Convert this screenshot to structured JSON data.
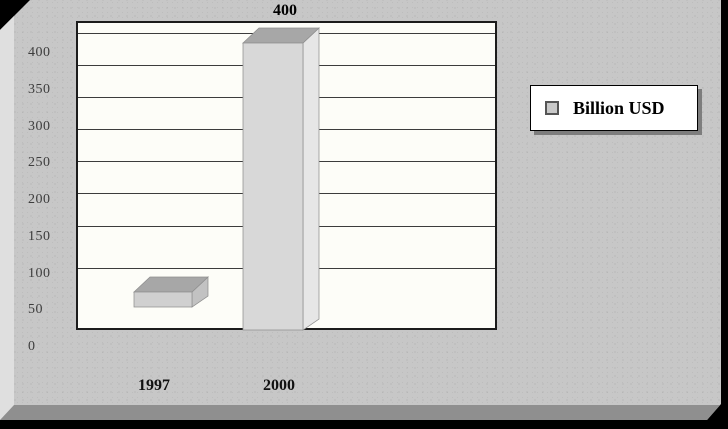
{
  "chart_data": {
    "type": "bar",
    "style": "3d-column",
    "title": "",
    "xlabel": "",
    "ylabel": "",
    "categories": [
      "1997",
      "2000"
    ],
    "series": [
      {
        "name": "Billion USD",
        "values": [
          70,
          400
        ]
      }
    ],
    "data_labels": [
      null,
      "400"
    ],
    "yticks_top_to_bottom": [
      "400",
      "350",
      "300",
      "250",
      "200",
      "150",
      "100",
      "50",
      "0"
    ],
    "ylim": [
      0,
      450
    ],
    "ytick_step": 50,
    "grid": true,
    "legend": {
      "label": "Billion USD",
      "position": "right",
      "marker_color": "#c9c9c9"
    },
    "colors": {
      "panel_bg": "#c7c7c7",
      "plot_bg": "#fdfdf8",
      "gridline": "#3c3c3c",
      "bar_top": "#a7a7a7",
      "edge": "#8f8f8f",
      "canvas": "#000000"
    },
    "layout": {
      "plot": {
        "x": 76,
        "y": 21,
        "w": 421,
        "h": 309
      },
      "gridlines_y": [
        32.5,
        64.5,
        97,
        129,
        161,
        193,
        225.5,
        268
      ],
      "tick_x": 28,
      "tick_y0": 53,
      "tick_dy": 36.75,
      "depth": {
        "dx": 16,
        "dy_top": 15,
        "dy_bot": 11
      },
      "bars": [
        {
          "front": {
            "x": 134,
            "y": 292,
            "w": 58,
            "h": 15
          },
          "front_fill": "#d0d0d0",
          "side_fill": "#c2c2c2"
        },
        {
          "front": {
            "x": 243,
            "y": 43,
            "w": 60,
            "h": 287
          },
          "front_fill": "#d8d8d8",
          "side_fill": "#e6e6e6"
        }
      ],
      "cat_centers_x": [
        154,
        279
      ],
      "data_label_center_x": 285
    }
  }
}
